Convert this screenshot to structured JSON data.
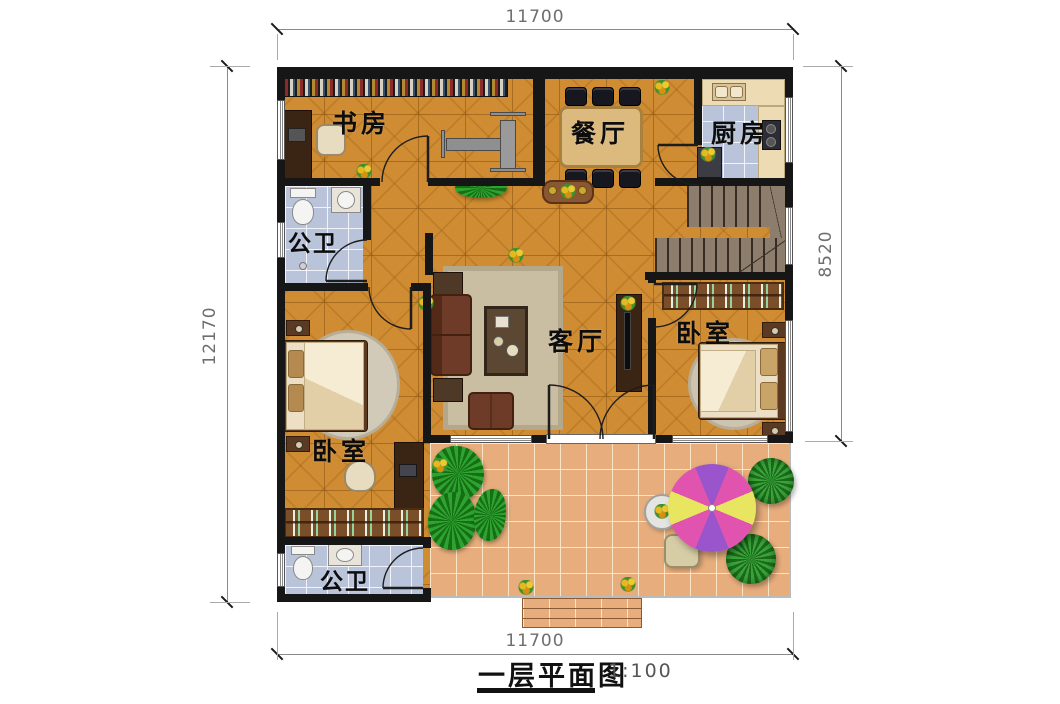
{
  "title": {
    "name": "一层平面图",
    "scale": "1:100"
  },
  "dims": {
    "top": "11700",
    "bottom": "11700",
    "left": "12170",
    "right": "8520"
  },
  "rooms": [
    {
      "id": "study",
      "label": "书房"
    },
    {
      "id": "dining",
      "label": "餐厅"
    },
    {
      "id": "kitchen",
      "label": "厨房"
    },
    {
      "id": "bath-top",
      "label": "公卫"
    },
    {
      "id": "living",
      "label": "客厅"
    },
    {
      "id": "bedroom-right",
      "label": "卧室"
    },
    {
      "id": "bedroom-left",
      "label": "卧室"
    },
    {
      "id": "bath-bottom",
      "label": "公卫"
    }
  ],
  "palette": {
    "wall": "#161616",
    "indoor_tile": "#d08c32",
    "patio_tile": "#e7ad7c",
    "bath_tile": "#b9c4da",
    "stair": "#8d7d6c",
    "umbrella_pink": "#e054b0",
    "umbrella_purple": "#9b55cc",
    "umbrella_yellow": "#e8e560",
    "plant_green": "#2fa32f",
    "sofa_brown": "#6e3b28"
  }
}
